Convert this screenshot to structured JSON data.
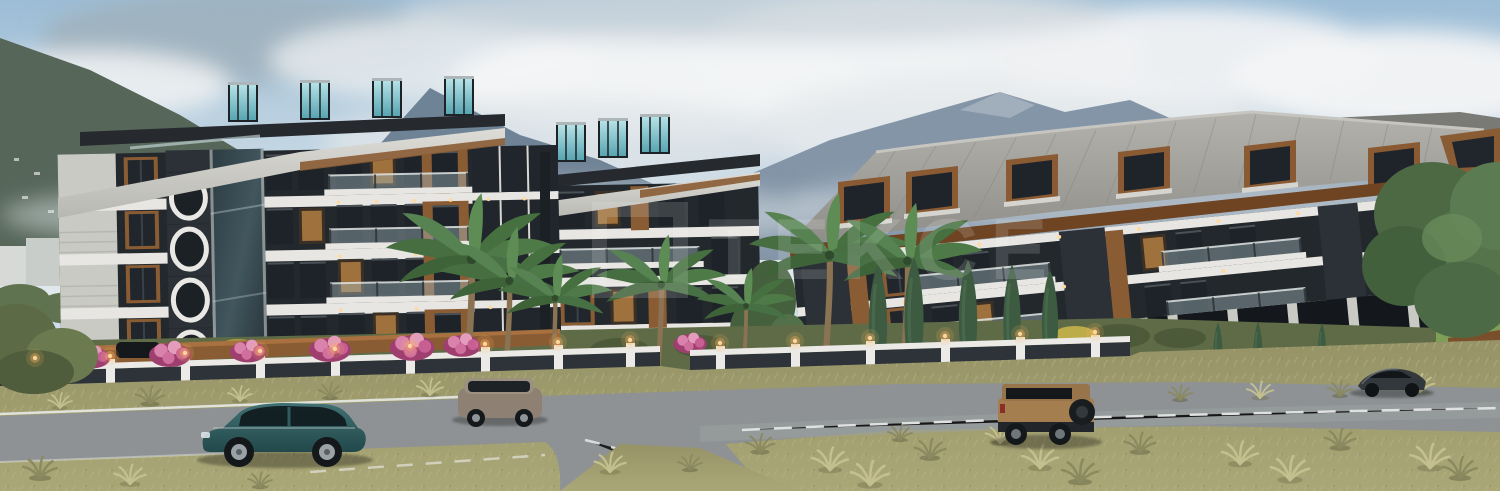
{
  "watermark": {
    "text": "TEKCE"
  },
  "palette": {
    "sky_top": "#9cbdd6",
    "sky_mid": "#cfdfe9",
    "cloud": "#f1f3f4",
    "cloud_shadow": "#b9c3cc",
    "mountain_far": "#7e90a3",
    "mountain_mid": "#697d91",
    "mountain_left": "#566659",
    "facade_white": "#e7e6e2",
    "facade_gray": "#c9cac4",
    "stone_dark": "#2b3136",
    "stone_mid": "#3a4147",
    "wood": "#8a5c34",
    "wood_dark": "#6e4423",
    "glass_dark": "#20262b",
    "window_warm": "#c98d4a",
    "roof_gray": "#a3a29d",
    "roof_side": "#74746f",
    "grass": "#a19e6e",
    "grass_light": "#bcb98a",
    "grass_dark": "#7e7c52",
    "garden_green": "#5f6b47",
    "green_tree": "#59774a",
    "cypress_green": "#3d5b41",
    "palm_green": "#4e7a48",
    "road": "#8e9294",
    "road_line": "#eceeec",
    "fence_white": "#eceae6",
    "fence_panel": "#2d3338",
    "flower_pink": "#d86fa0",
    "flower_yellow": "#c8b44a",
    "lamp_glow": "#ffb25e",
    "suv_teal": "#2f5c5e",
    "suv_gray": "#8e8173",
    "jeep_tan": "#a57e4f",
    "car_dark": "#2e3236"
  }
}
